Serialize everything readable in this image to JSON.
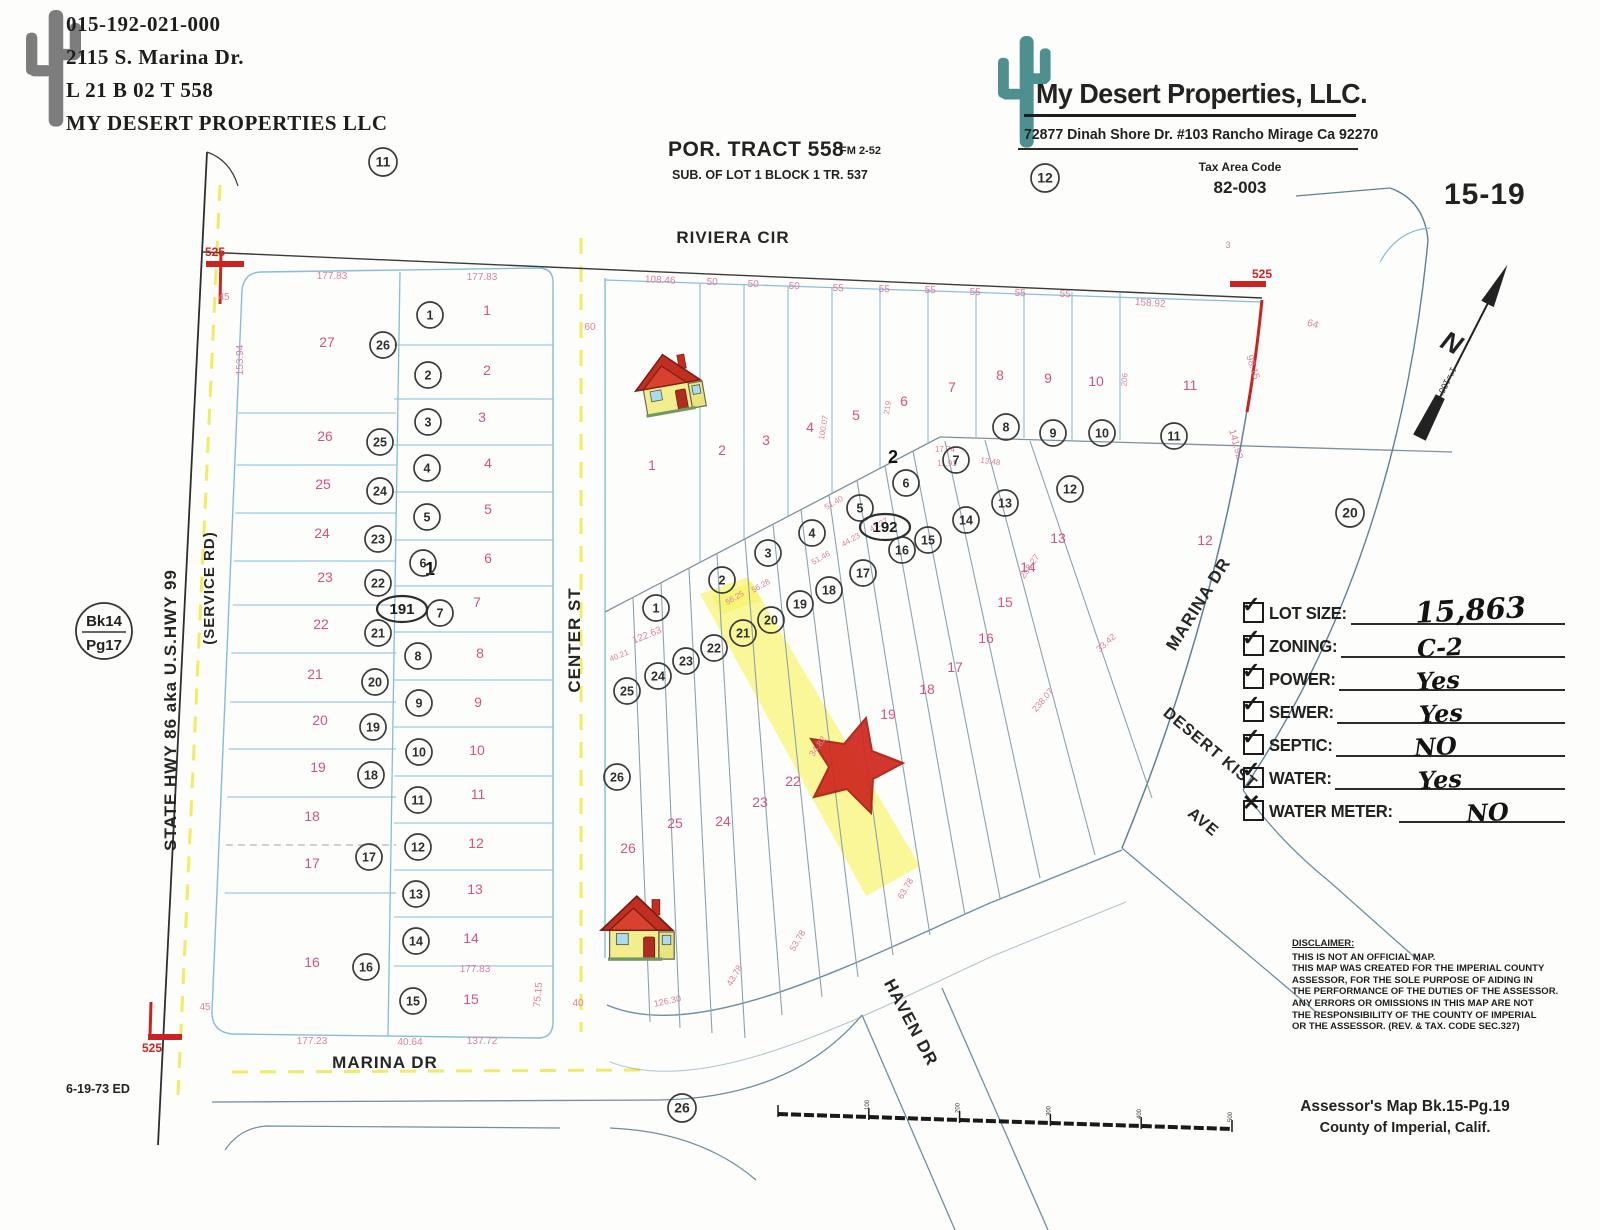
{
  "owner_block": {
    "parcel_id": "015-192-021-000",
    "address": "2115 S. Marina Dr.",
    "lot_line": "L  21   B  02   T  558",
    "owner": "MY DESERT PROPERTIES LLC"
  },
  "tract_title": {
    "main": "POR. TRACT 558",
    "fm": "FM  2-52",
    "sub": "SUB. OF LOT 1 BLOCK 1 TR. 537"
  },
  "company_block": {
    "name": "My Desert Properties, LLC.",
    "address": "72877 Dinah Shore Dr. #103 Rancho Mirage Ca 92270",
    "tax_area_label": "Tax Area Code",
    "tax_area_code": "82-003"
  },
  "sheet_number": "15-19",
  "book_page_circle": {
    "top": "Bk14",
    "bottom": "Pg17"
  },
  "north_arrow": {
    "letter": "N",
    "scale": "1\"=100'"
  },
  "checklist": [
    {
      "label": "LOT SIZE:",
      "value": "15,863",
      "mark": "✓",
      "big": true,
      "valpos": "30%"
    },
    {
      "label": "ZONING:",
      "value": "C-2",
      "mark": "✓",
      "big": false,
      "valpos": "34%"
    },
    {
      "label": "POWER:",
      "value": "Yes",
      "mark": "✓",
      "big": false,
      "valpos": "34%"
    },
    {
      "label": "SEWER:",
      "value": "Yes",
      "mark": "✓",
      "big": false,
      "valpos": "36%"
    },
    {
      "label": "SEPTIC:",
      "value": "NO",
      "mark": "✓",
      "big": false,
      "valpos": "34%"
    },
    {
      "label": "WATER:",
      "value": "Yes",
      "mark": "✓",
      "big": false,
      "valpos": "36%"
    },
    {
      "label": "WATER METER:",
      "value": "NO",
      "mark": "✕",
      "big": false,
      "valpos": "40%"
    }
  ],
  "disclaimer": {
    "title": "DISCLAIMER:",
    "lines": [
      "THIS IS NOT AN OFFICIAL MAP.",
      "THIS MAP WAS CREATED FOR THE IMPERIAL COUNTY",
      "ASSESSOR, FOR THE SOLE PURPOSE OF AIDING IN",
      "THE PERFORMANCE OF THE DUTIES OF THE ASSESSOR.",
      "ANY ERRORS OR OMISSIONS IN THIS MAP ARE NOT",
      "THE RESPONSIBILITY OF THE COUNTY OF IMPERIAL",
      "OR THE ASSESSOR. (REV. & TAX. CODE SEC.327)"
    ]
  },
  "footer": {
    "line1": "Assessor's Map Bk.15-Pg.19",
    "line2": "County of Imperial, Calif.",
    "date_note": "6-19-73 ED"
  },
  "map": {
    "colors": {
      "pink": "#d4537f",
      "dim_pink": "#d9839f",
      "red": "#cc2222",
      "ink": "#2b2b2b"
    },
    "street_labels": [
      {
        "t": "RIVIERA CIR",
        "x": 733,
        "y": 243,
        "rot": 0,
        "s": 17
      },
      {
        "t": "CENTER ST",
        "x": 580,
        "y": 640,
        "rot": -90,
        "s": 17
      },
      {
        "t": "MARINA DR",
        "x": 385,
        "y": 1068,
        "rot": 0,
        "s": 17
      },
      {
        "t": "MARINA DR",
        "x": 1203,
        "y": 607,
        "rot": -58,
        "s": 17
      },
      {
        "t": "HAVEN DR",
        "x": 906,
        "y": 1025,
        "rot": 62,
        "s": 17
      },
      {
        "t": "DESERT KIST",
        "x": 1207,
        "y": 752,
        "rot": 40,
        "s": 16
      },
      {
        "t": "AVE",
        "x": 1200,
        "y": 826,
        "rot": 40,
        "s": 16
      },
      {
        "t": "STATE HWY 86 aka U.S.HWY 99",
        "x": 176,
        "y": 710,
        "rot": -90,
        "s": 17
      },
      {
        "t": "(SERVICE RD)",
        "x": 214,
        "y": 588,
        "rot": -90,
        "s": 15
      }
    ],
    "circled_numbers": [
      {
        "n": "11",
        "x": 383,
        "y": 162,
        "r": 14
      },
      {
        "n": "12",
        "x": 1045,
        "y": 178,
        "r": 14
      },
      {
        "n": "26",
        "x": 383,
        "y": 345,
        "r": 13
      },
      {
        "n": "25",
        "x": 380,
        "y": 442,
        "r": 13
      },
      {
        "n": "24",
        "x": 380,
        "y": 491,
        "r": 13
      },
      {
        "n": "23",
        "x": 378,
        "y": 539,
        "r": 13
      },
      {
        "n": "22",
        "x": 378,
        "y": 583,
        "r": 13
      },
      {
        "n": "21",
        "x": 378,
        "y": 633,
        "r": 13
      },
      {
        "n": "20",
        "x": 375,
        "y": 682,
        "r": 13
      },
      {
        "n": "19",
        "x": 373,
        "y": 727,
        "r": 13
      },
      {
        "n": "18",
        "x": 371,
        "y": 775,
        "r": 13
      },
      {
        "n": "17",
        "x": 369,
        "y": 857,
        "r": 13
      },
      {
        "n": "16",
        "x": 366,
        "y": 967,
        "r": 13
      },
      {
        "n": "1",
        "x": 430,
        "y": 315,
        "r": 13
      },
      {
        "n": "2",
        "x": 428,
        "y": 375,
        "r": 13
      },
      {
        "n": "3",
        "x": 428,
        "y": 422,
        "r": 13
      },
      {
        "n": "4",
        "x": 427,
        "y": 468,
        "r": 13
      },
      {
        "n": "5",
        "x": 427,
        "y": 517,
        "r": 13
      },
      {
        "n": "6",
        "x": 423,
        "y": 563,
        "r": 13
      },
      {
        "n": "7",
        "x": 440,
        "y": 613,
        "r": 13
      },
      {
        "n": "8",
        "x": 418,
        "y": 656,
        "r": 13
      },
      {
        "n": "9",
        "x": 419,
        "y": 703,
        "r": 13
      },
      {
        "n": "10",
        "x": 419,
        "y": 752,
        "r": 13
      },
      {
        "n": "11",
        "x": 418,
        "y": 800,
        "r": 13
      },
      {
        "n": "12",
        "x": 418,
        "y": 847,
        "r": 13
      },
      {
        "n": "13",
        "x": 416,
        "y": 894,
        "r": 13
      },
      {
        "n": "14",
        "x": 416,
        "y": 941,
        "r": 13
      },
      {
        "n": "15",
        "x": 413,
        "y": 1001,
        "r": 13
      },
      {
        "n": "1",
        "x": 656,
        "y": 608,
        "r": 13
      },
      {
        "n": "2",
        "x": 722,
        "y": 580,
        "r": 13
      },
      {
        "n": "3",
        "x": 768,
        "y": 553,
        "r": 13
      },
      {
        "n": "4",
        "x": 812,
        "y": 533,
        "r": 13
      },
      {
        "n": "5",
        "x": 860,
        "y": 508,
        "r": 13
      },
      {
        "n": "6",
        "x": 906,
        "y": 483,
        "r": 13
      },
      {
        "n": "7",
        "x": 956,
        "y": 460,
        "r": 13
      },
      {
        "n": "8",
        "x": 1006,
        "y": 427,
        "r": 13
      },
      {
        "n": "9",
        "x": 1053,
        "y": 433,
        "r": 13
      },
      {
        "n": "10",
        "x": 1102,
        "y": 433,
        "r": 13
      },
      {
        "n": "11",
        "x": 1174,
        "y": 436,
        "r": 13
      },
      {
        "n": "12",
        "x": 1070,
        "y": 489,
        "r": 13
      },
      {
        "n": "13",
        "x": 1005,
        "y": 503,
        "r": 13
      },
      {
        "n": "14",
        "x": 966,
        "y": 520,
        "r": 13
      },
      {
        "n": "15",
        "x": 928,
        "y": 540,
        "r": 13
      },
      {
        "n": "16",
        "x": 902,
        "y": 550,
        "r": 13
      },
      {
        "n": "17",
        "x": 863,
        "y": 573,
        "r": 13
      },
      {
        "n": "18",
        "x": 829,
        "y": 590,
        "r": 13
      },
      {
        "n": "19",
        "x": 800,
        "y": 604,
        "r": 13
      },
      {
        "n": "20",
        "x": 771,
        "y": 620,
        "r": 13
      },
      {
        "n": "21",
        "x": 743,
        "y": 633,
        "r": 13
      },
      {
        "n": "22",
        "x": 714,
        "y": 648,
        "r": 13
      },
      {
        "n": "23",
        "x": 686,
        "y": 661,
        "r": 13
      },
      {
        "n": "24",
        "x": 658,
        "y": 676,
        "r": 13
      },
      {
        "n": "25",
        "x": 627,
        "y": 691,
        "r": 13
      },
      {
        "n": "26",
        "x": 617,
        "y": 777,
        "r": 13
      },
      {
        "n": "26",
        "x": 682,
        "y": 1108,
        "r": 14
      },
      {
        "n": "20",
        "x": 1350,
        "y": 513,
        "r": 14
      }
    ],
    "oval_numbers": [
      {
        "n": "191",
        "x": 402,
        "y": 609
      },
      {
        "n": "192",
        "x": 885,
        "y": 527
      }
    ],
    "pink_lot_numbers": [
      {
        "n": "27",
        "x": 327,
        "y": 347
      },
      {
        "n": "26",
        "x": 325,
        "y": 441
      },
      {
        "n": "25",
        "x": 323,
        "y": 489
      },
      {
        "n": "24",
        "x": 322,
        "y": 538
      },
      {
        "n": "23",
        "x": 325,
        "y": 582
      },
      {
        "n": "22",
        "x": 321,
        "y": 629
      },
      {
        "n": "21",
        "x": 315,
        "y": 679
      },
      {
        "n": "20",
        "x": 320,
        "y": 725
      },
      {
        "n": "19",
        "x": 318,
        "y": 772
      },
      {
        "n": "18",
        "x": 312,
        "y": 821
      },
      {
        "n": "17",
        "x": 312,
        "y": 868
      },
      {
        "n": "16",
        "x": 312,
        "y": 967
      },
      {
        "n": "1",
        "x": 487,
        "y": 315
      },
      {
        "n": "2",
        "x": 487,
        "y": 375
      },
      {
        "n": "3",
        "x": 482,
        "y": 422
      },
      {
        "n": "4",
        "x": 488,
        "y": 468
      },
      {
        "n": "5",
        "x": 488,
        "y": 514
      },
      {
        "n": "6",
        "x": 488,
        "y": 563
      },
      {
        "n": "7",
        "x": 477,
        "y": 607
      },
      {
        "n": "8",
        "x": 480,
        "y": 658
      },
      {
        "n": "9",
        "x": 478,
        "y": 707
      },
      {
        "n": "10",
        "x": 477,
        "y": 755
      },
      {
        "n": "11",
        "x": 478,
        "y": 799
      },
      {
        "n": "12",
        "x": 476,
        "y": 848
      },
      {
        "n": "13",
        "x": 475,
        "y": 894
      },
      {
        "n": "14",
        "x": 471,
        "y": 943
      },
      {
        "n": "15",
        "x": 471,
        "y": 1004
      },
      {
        "n": "1",
        "x": 652,
        "y": 470
      },
      {
        "n": "2",
        "x": 722,
        "y": 455
      },
      {
        "n": "3",
        "x": 766,
        "y": 445
      },
      {
        "n": "4",
        "x": 810,
        "y": 432
      },
      {
        "n": "5",
        "x": 856,
        "y": 420
      },
      {
        "n": "6",
        "x": 904,
        "y": 406
      },
      {
        "n": "7",
        "x": 952,
        "y": 392
      },
      {
        "n": "8",
        "x": 1000,
        "y": 380
      },
      {
        "n": "9",
        "x": 1048,
        "y": 383
      },
      {
        "n": "10",
        "x": 1096,
        "y": 386
      },
      {
        "n": "11",
        "x": 1190,
        "y": 390
      },
      {
        "n": "12",
        "x": 1205,
        "y": 545
      },
      {
        "n": "13",
        "x": 1058,
        "y": 543
      },
      {
        "n": "14",
        "x": 1028,
        "y": 572
      },
      {
        "n": "15",
        "x": 1005,
        "y": 607
      },
      {
        "n": "16",
        "x": 986,
        "y": 643
      },
      {
        "n": "17",
        "x": 955,
        "y": 672
      },
      {
        "n": "18",
        "x": 927,
        "y": 694
      },
      {
        "n": "19",
        "x": 888,
        "y": 719
      },
      {
        "n": "22",
        "x": 793,
        "y": 786
      },
      {
        "n": "23",
        "x": 760,
        "y": 807
      },
      {
        "n": "24",
        "x": 723,
        "y": 826
      },
      {
        "n": "25",
        "x": 675,
        "y": 828
      },
      {
        "n": "26",
        "x": 628,
        "y": 853
      }
    ],
    "dim_labels": [
      {
        "t": "177.83",
        "x": 332,
        "y": 279
      },
      {
        "t": "177.83",
        "x": 482,
        "y": 280
      },
      {
        "t": "108.46",
        "x": 660,
        "y": 283,
        "rot": 3
      },
      {
        "t": "50",
        "x": 712,
        "y": 285,
        "rot": 3
      },
      {
        "t": "50",
        "x": 753,
        "y": 287,
        "rot": 3
      },
      {
        "t": "50",
        "x": 794,
        "y": 289,
        "rot": 3
      },
      {
        "t": "55",
        "x": 838,
        "y": 291,
        "rot": 3
      },
      {
        "t": "55",
        "x": 884,
        "y": 292,
        "rot": 3
      },
      {
        "t": "55",
        "x": 930,
        "y": 293,
        "rot": 3
      },
      {
        "t": "55",
        "x": 975,
        "y": 295,
        "rot": 3
      },
      {
        "t": "55",
        "x": 1020,
        "y": 296,
        "rot": 3
      },
      {
        "t": "55",
        "x": 1065,
        "y": 297,
        "rot": 3
      },
      {
        "t": "158.92",
        "x": 1150,
        "y": 306,
        "rot": 4
      },
      {
        "t": "3",
        "x": 1228,
        "y": 248,
        "s": 9
      },
      {
        "t": "64",
        "x": 1312,
        "y": 327,
        "rot": 15
      },
      {
        "t": "98.15",
        "x": 1250,
        "y": 368,
        "rot": 72
      },
      {
        "t": "141.92",
        "x": 1233,
        "y": 445,
        "rot": 75
      },
      {
        "t": "45",
        "x": 224,
        "y": 300
      },
      {
        "t": "45",
        "x": 205,
        "y": 1010
      },
      {
        "t": "153.94",
        "x": 243,
        "y": 360,
        "rot": -90
      },
      {
        "t": "60",
        "x": 590,
        "y": 330
      },
      {
        "t": "40",
        "x": 578,
        "y": 1006
      },
      {
        "t": "75.15",
        "x": 541,
        "y": 995,
        "rot": -85
      },
      {
        "t": "177.83",
        "x": 475,
        "y": 972
      },
      {
        "t": "177.23",
        "x": 312,
        "y": 1044
      },
      {
        "t": "40.64",
        "x": 410,
        "y": 1045
      },
      {
        "t": "137.72",
        "x": 482,
        "y": 1044
      },
      {
        "t": "122.63",
        "x": 648,
        "y": 638,
        "rot": -22
      },
      {
        "t": "40.21",
        "x": 620,
        "y": 658,
        "rot": -22,
        "s": 8
      },
      {
        "t": "56.25",
        "x": 736,
        "y": 600,
        "rot": -30,
        "s": 8
      },
      {
        "t": "56.28",
        "x": 762,
        "y": 588,
        "rot": -30,
        "s": 8
      },
      {
        "t": "51.46",
        "x": 822,
        "y": 560,
        "rot": -30,
        "s": 8
      },
      {
        "t": "44.23",
        "x": 852,
        "y": 542,
        "rot": -30,
        "s": 8
      },
      {
        "t": "41.37",
        "x": 880,
        "y": 527,
        "rot": -30,
        "s": 8
      },
      {
        "t": "51.40",
        "x": 835,
        "y": 505,
        "rot": -30,
        "s": 8
      },
      {
        "t": "17.74",
        "x": 945,
        "y": 452,
        "s": 8
      },
      {
        "t": "11.91",
        "x": 947,
        "y": 466,
        "s": 8
      },
      {
        "t": "13.48",
        "x": 990,
        "y": 464,
        "rot": 8,
        "s": 8
      },
      {
        "t": "258.27",
        "x": 1032,
        "y": 568,
        "rot": -55,
        "s": 9
      },
      {
        "t": "238.07",
        "x": 1045,
        "y": 702,
        "rot": -50,
        "s": 9
      },
      {
        "t": "33.42",
        "x": 1108,
        "y": 645,
        "rot": -42,
        "s": 9
      },
      {
        "t": "100.07",
        "x": 826,
        "y": 428,
        "rot": -80,
        "s": 8
      },
      {
        "t": "219",
        "x": 890,
        "y": 408,
        "rot": -80,
        "s": 8
      },
      {
        "t": "206",
        "x": 1127,
        "y": 380,
        "rot": -85,
        "s": 8
      },
      {
        "t": "34.82",
        "x": 820,
        "y": 748,
        "rot": -55,
        "s": 9
      },
      {
        "t": "43.78",
        "x": 737,
        "y": 977,
        "rot": -60,
        "s": 9
      },
      {
        "t": "53.78",
        "x": 800,
        "y": 942,
        "rot": -60,
        "s": 9
      },
      {
        "t": "63.78",
        "x": 908,
        "y": 890,
        "rot": -60,
        "s": 9
      },
      {
        "t": "126.30",
        "x": 668,
        "y": 1004,
        "rot": -12,
        "s": 9
      }
    ],
    "red_labels": [
      {
        "t": "525",
        "x": 215,
        "y": 256
      },
      {
        "t": "525",
        "x": 1262,
        "y": 278
      },
      {
        "t": "525",
        "x": 152,
        "y": 1052
      }
    ],
    "handwritten_numbers": [
      {
        "t": "2",
        "x": 893,
        "y": 463
      },
      {
        "t": "1",
        "x": 430,
        "y": 575
      }
    ],
    "scalebar_labels": [
      "100",
      "200",
      "300",
      "400",
      "500"
    ]
  }
}
